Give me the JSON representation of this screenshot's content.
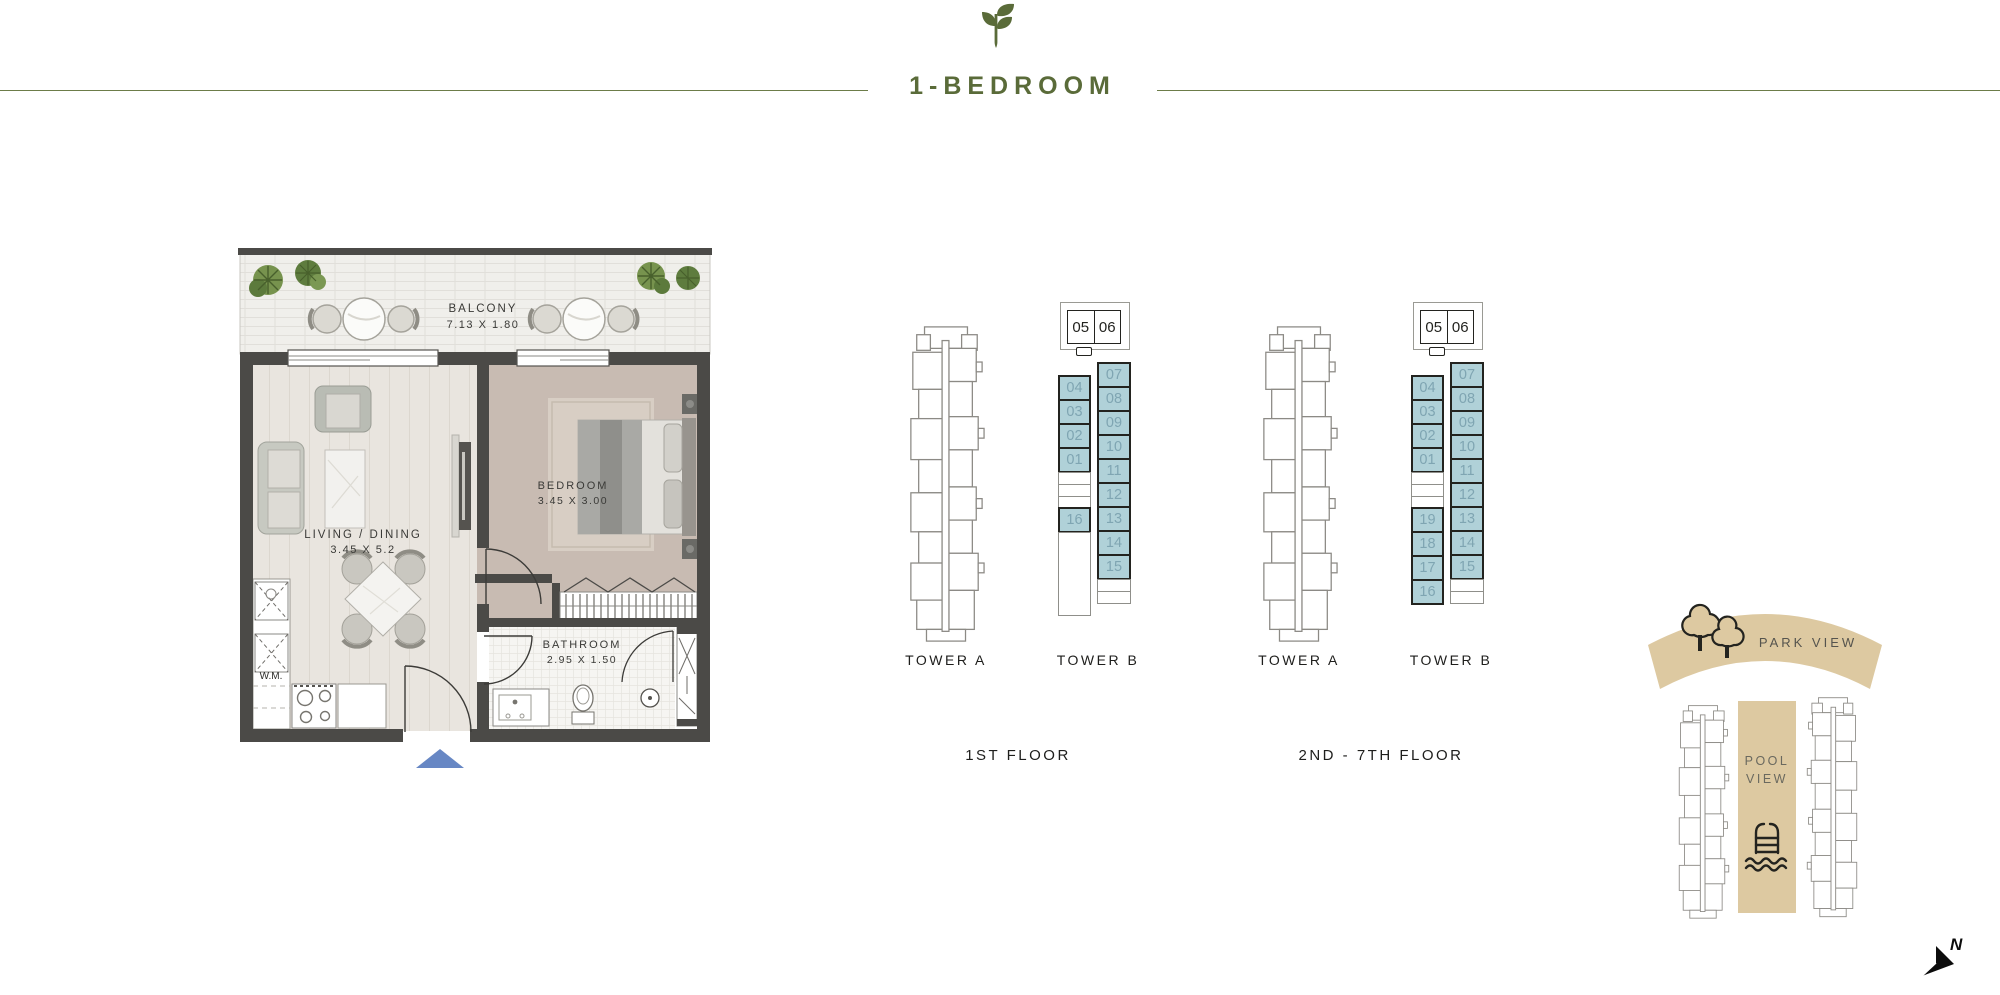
{
  "header": {
    "title": "1-BEDROOM"
  },
  "floorplan": {
    "balcony_label": "BALCONY",
    "balcony_dims": "7.13 X 1.80",
    "living_label": "LIVING / DINING",
    "living_dims": "3.45 X 5.2",
    "bedroom_label": "BEDROOM",
    "bedroom_dims": "3.45 X 3.00",
    "bathroom_label": "BATHROOM",
    "bathroom_dims": "2.95 X 1.50",
    "wm_label": "W.M."
  },
  "diagrams": [
    {
      "floor_label": "1ST FLOOR",
      "tower_a_label": "TOWER A",
      "tower_b_label": "TOWER B",
      "header_units": [
        "05",
        "06"
      ],
      "left_column": [
        {
          "label": "04",
          "hl": true
        },
        {
          "label": "03",
          "hl": true
        },
        {
          "label": "02",
          "hl": true
        },
        {
          "label": "01",
          "hl": true
        },
        {
          "label": "",
          "hl": false
        },
        {
          "label": "",
          "hl": false
        },
        {
          "label": "",
          "hl": false
        },
        {
          "label": "16",
          "hl": true
        },
        {
          "label": "",
          "hl": false,
          "tall": true
        }
      ],
      "right_column": [
        {
          "label": "07",
          "hl": true
        },
        {
          "label": "08",
          "hl": true
        },
        {
          "label": "09",
          "hl": true
        },
        {
          "label": "10",
          "hl": true
        },
        {
          "label": "11",
          "hl": true
        },
        {
          "label": "12",
          "hl": true
        },
        {
          "label": "13",
          "hl": true
        },
        {
          "label": "14",
          "hl": true
        },
        {
          "label": "15",
          "hl": true
        },
        {
          "label": "",
          "hl": false
        },
        {
          "label": "",
          "hl": false
        }
      ]
    },
    {
      "floor_label": "2ND - 7TH FLOOR",
      "tower_a_label": "TOWER A",
      "tower_b_label": "TOWER B",
      "header_units": [
        "05",
        "06"
      ],
      "left_column": [
        {
          "label": "04",
          "hl": true
        },
        {
          "label": "03",
          "hl": true
        },
        {
          "label": "02",
          "hl": true
        },
        {
          "label": "01",
          "hl": true
        },
        {
          "label": "",
          "hl": false
        },
        {
          "label": "",
          "hl": false
        },
        {
          "label": "",
          "hl": false
        },
        {
          "label": "19",
          "hl": true
        },
        {
          "label": "18",
          "hl": true
        },
        {
          "label": "17",
          "hl": true
        },
        {
          "label": "16",
          "hl": true
        }
      ],
      "right_column": [
        {
          "label": "07",
          "hl": true
        },
        {
          "label": "08",
          "hl": true
        },
        {
          "label": "09",
          "hl": true
        },
        {
          "label": "10",
          "hl": true
        },
        {
          "label": "11",
          "hl": true
        },
        {
          "label": "12",
          "hl": true
        },
        {
          "label": "13",
          "hl": true
        },
        {
          "label": "14",
          "hl": true
        },
        {
          "label": "15",
          "hl": true
        },
        {
          "label": "",
          "hl": false
        },
        {
          "label": "",
          "hl": false
        }
      ]
    }
  ],
  "siteplan": {
    "park_label": "PARK VIEW",
    "pool_label_line1": "POOL",
    "pool_label_line2": "VIEW",
    "north_label": "N"
  },
  "colors": {
    "accent_olive": "#5a6b39",
    "unit_highlight": "#b0d1d8",
    "unit_number": "#7fa5b2",
    "outline_dark": "#23231f",
    "site_tan": "#ddc9a1",
    "wall_gray": "#4b4a47",
    "entry_marker_blue": "#6787c4"
  }
}
